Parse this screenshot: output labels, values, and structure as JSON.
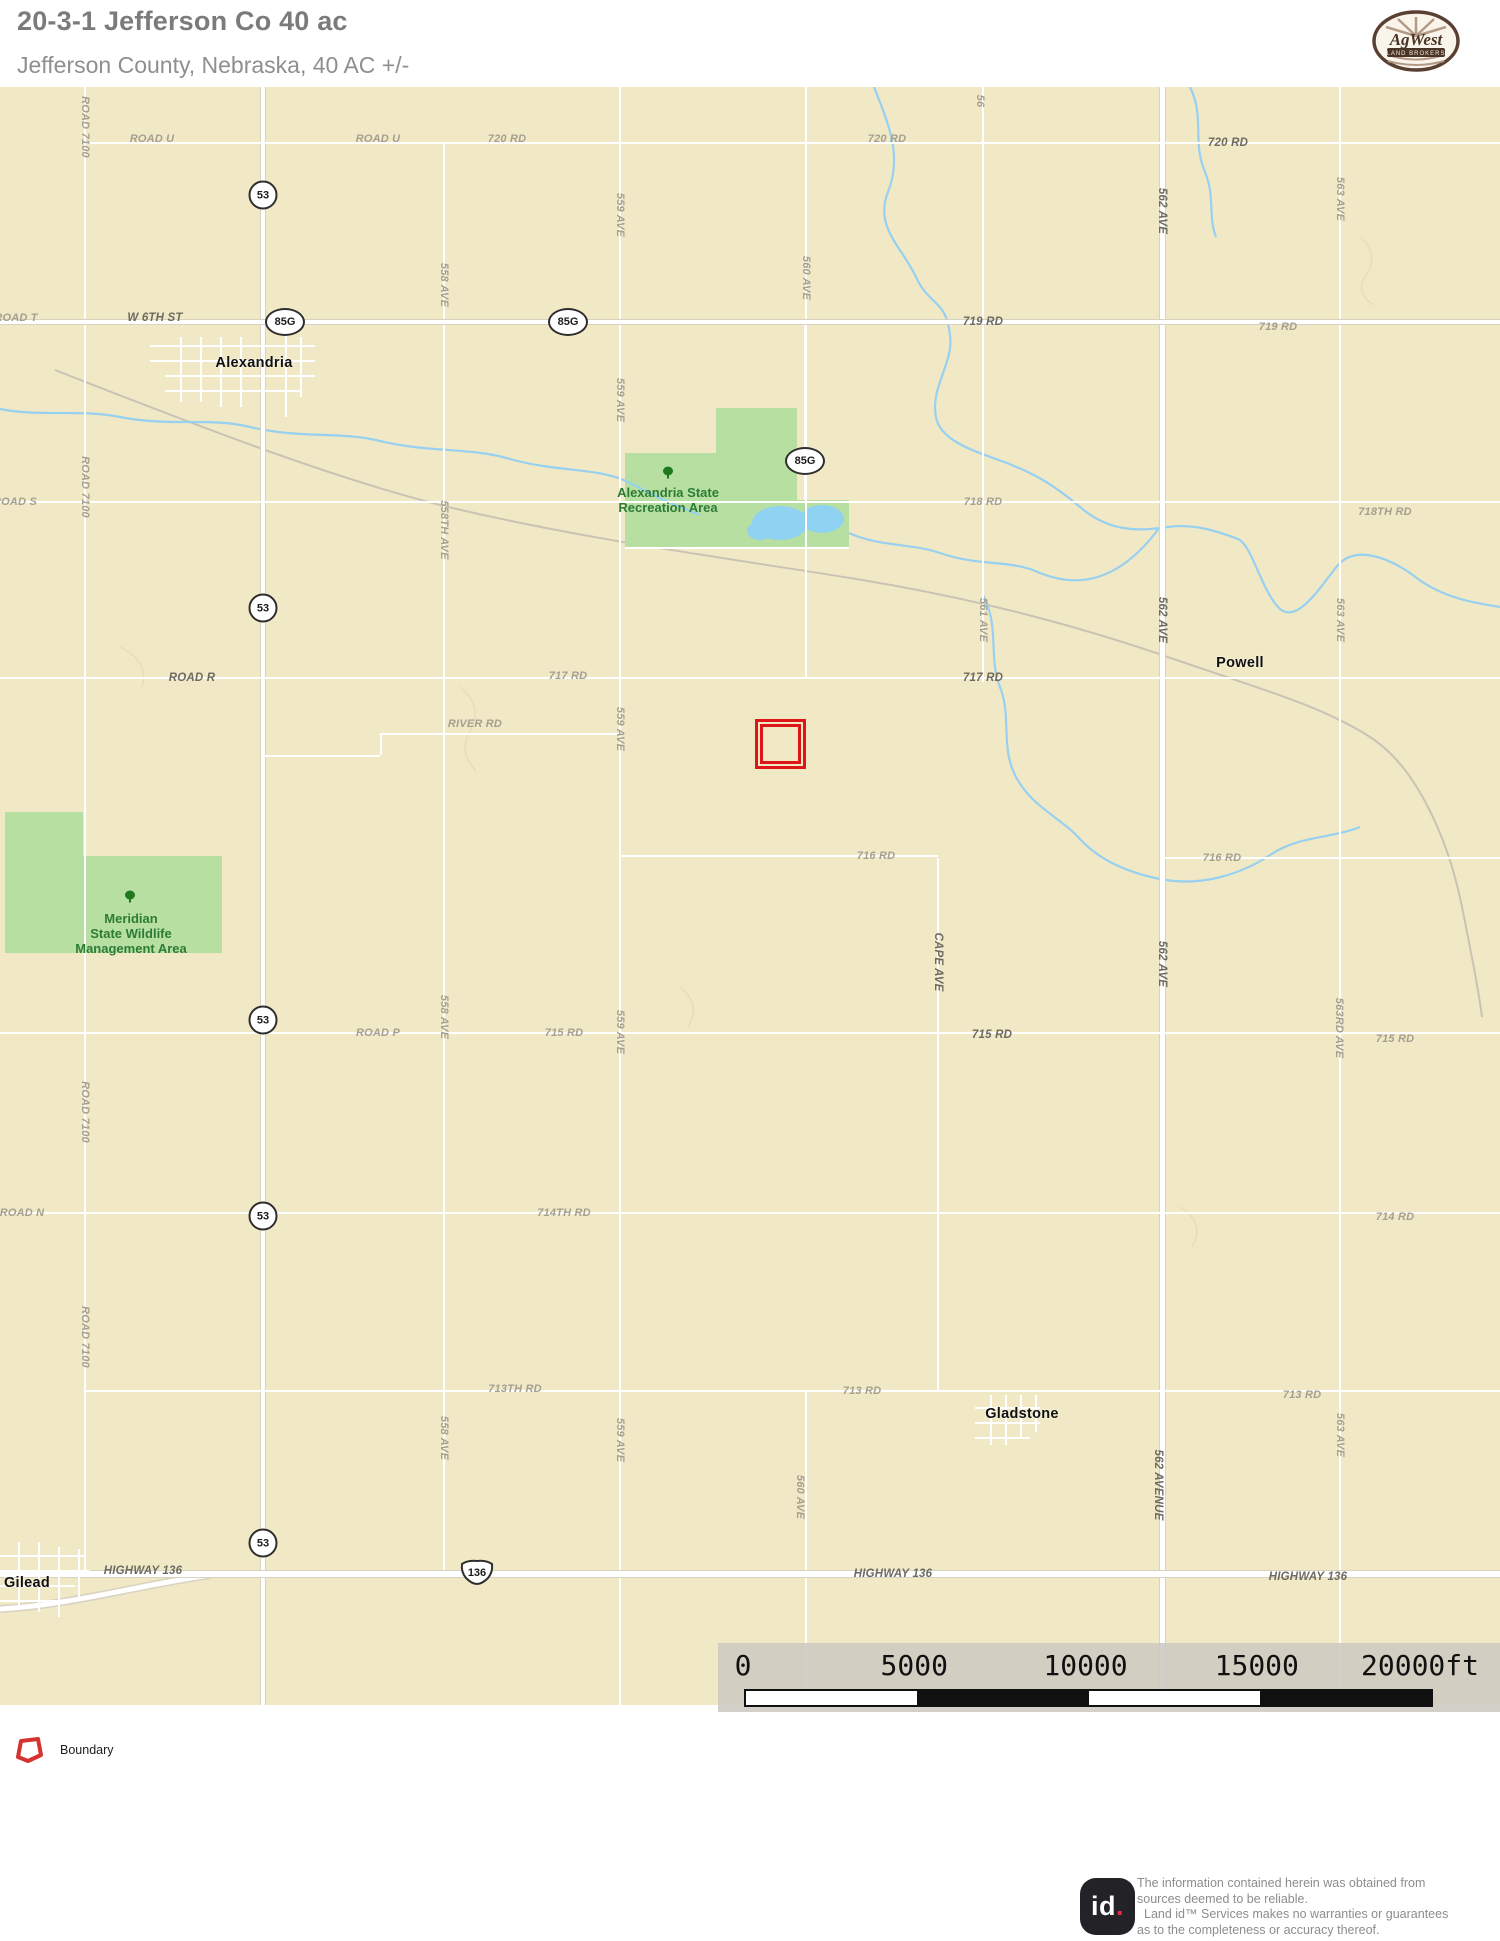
{
  "header": {
    "title": "20-3-1 Jefferson Co 40 ac",
    "subtitle": "Jefferson County, Nebraska, 40 AC +/-"
  },
  "brand": {
    "name": "AgWest",
    "tagline": "LAND BROKERS"
  },
  "colors": {
    "map_background": "#f1e9c5",
    "boundary_red": "#dd1717",
    "water_blue": "#8fd2f2",
    "park_green": "#b8dfa2",
    "park_text_green": "#2c7c35",
    "road_white": "#ffffff",
    "label_gray": "#a59f92"
  },
  "map": {
    "towns": [
      {
        "name": "Alexandria",
        "x": 254,
        "y": 276
      },
      {
        "name": "Powell",
        "x": 1240,
        "y": 576
      },
      {
        "name": "Gladstone",
        "x": 1022,
        "y": 1327
      },
      {
        "name": "Gilead",
        "x": 27,
        "y": 1496
      }
    ],
    "areas": [
      {
        "name": "Alexandria State Recreation Area",
        "lines": [
          "Alexandria State",
          "Recreation Area"
        ],
        "x": 668,
        "y": 398,
        "tree_x": 668,
        "tree_y": 388
      },
      {
        "name": "Meridian State Wildlife Management Area",
        "lines": [
          "Meridian",
          "State Wildlife",
          "Management Area"
        ],
        "x": 131,
        "y": 824,
        "tree_x": 130,
        "tree_y": 812
      }
    ],
    "shields": [
      {
        "type": "circle",
        "label": "53",
        "x": 263,
        "y": 108
      },
      {
        "type": "circle",
        "label": "53",
        "x": 263,
        "y": 521
      },
      {
        "type": "circle",
        "label": "53",
        "x": 263,
        "y": 933
      },
      {
        "type": "circle",
        "label": "53",
        "x": 263,
        "y": 1129
      },
      {
        "type": "circle",
        "label": "53",
        "x": 263,
        "y": 1456
      },
      {
        "type": "oval",
        "label": "85G",
        "x": 285,
        "y": 235
      },
      {
        "type": "oval",
        "label": "85G",
        "x": 568,
        "y": 235
      },
      {
        "type": "oval",
        "label": "85G",
        "x": 805,
        "y": 374
      },
      {
        "type": "us",
        "label": "136",
        "x": 477,
        "y": 1485
      }
    ],
    "road_labels": [
      {
        "text": "ROAD U",
        "x": 152,
        "y": 52
      },
      {
        "text": "ROAD U",
        "x": 378,
        "y": 52
      },
      {
        "text": "720 RD",
        "x": 507,
        "y": 52
      },
      {
        "text": "720 RD",
        "x": 887,
        "y": 52
      },
      {
        "text": "720 RD",
        "x": 1228,
        "y": 56,
        "bold": true
      },
      {
        "text": "ROAD T",
        "x": 16,
        "y": 231
      },
      {
        "text": "W 6TH ST",
        "x": 155,
        "y": 231,
        "bold": true
      },
      {
        "text": "719 RD",
        "x": 983,
        "y": 235,
        "bold": true
      },
      {
        "text": "719 RD",
        "x": 1278,
        "y": 240
      },
      {
        "text": "ROAD S",
        "x": 15,
        "y": 415
      },
      {
        "text": "718 RD",
        "x": 983,
        "y": 415
      },
      {
        "text": "718TH RD",
        "x": 1385,
        "y": 425
      },
      {
        "text": "ROAD R",
        "x": 192,
        "y": 591,
        "bold": true
      },
      {
        "text": "717 RD",
        "x": 568,
        "y": 589
      },
      {
        "text": "717 RD",
        "x": 983,
        "y": 591,
        "bold": true
      },
      {
        "text": "RIVER RD",
        "x": 475,
        "y": 637
      },
      {
        "text": "716 RD",
        "x": 876,
        "y": 769
      },
      {
        "text": "716 RD",
        "x": 1222,
        "y": 771
      },
      {
        "text": "ROAD P",
        "x": 378,
        "y": 946
      },
      {
        "text": "715 RD",
        "x": 564,
        "y": 946
      },
      {
        "text": "715 RD",
        "x": 992,
        "y": 948,
        "bold": true
      },
      {
        "text": "715 RD",
        "x": 1395,
        "y": 952
      },
      {
        "text": "ROAD N",
        "x": 22,
        "y": 1126
      },
      {
        "text": "714TH RD",
        "x": 564,
        "y": 1126
      },
      {
        "text": "714 RD",
        "x": 1395,
        "y": 1130
      },
      {
        "text": "713TH RD",
        "x": 515,
        "y": 1302
      },
      {
        "text": "713 RD",
        "x": 862,
        "y": 1304
      },
      {
        "text": "713 RD",
        "x": 1302,
        "y": 1308
      },
      {
        "text": "HIGHWAY 136",
        "x": 143,
        "y": 1484,
        "bold": true
      },
      {
        "text": "HIGHWAY 136",
        "x": 893,
        "y": 1487,
        "bold": true
      },
      {
        "text": "HIGHWAY 136",
        "x": 1308,
        "y": 1490,
        "bold": true
      }
    ],
    "vertical_labels": [
      {
        "text": "ROAD 7100",
        "x": 85,
        "y": 40
      },
      {
        "text": "ROAD 7100",
        "x": 85,
        "y": 400
      },
      {
        "text": "ROAD 7100",
        "x": 85,
        "y": 1025
      },
      {
        "text": "ROAD 7100",
        "x": 85,
        "y": 1250
      },
      {
        "text": "558 AVE",
        "x": 444,
        "y": 198
      },
      {
        "text": "558TH AVE",
        "x": 444,
        "y": 443
      },
      {
        "text": "558 AVE",
        "x": 444,
        "y": 930
      },
      {
        "text": "558 AVE",
        "x": 444,
        "y": 1351
      },
      {
        "text": "559 AVE",
        "x": 620,
        "y": 128
      },
      {
        "text": "559 AVE",
        "x": 620,
        "y": 313
      },
      {
        "text": "559 AVE",
        "x": 620,
        "y": 642
      },
      {
        "text": "559 AVE",
        "x": 620,
        "y": 945
      },
      {
        "text": "559 AVE",
        "x": 620,
        "y": 1353
      },
      {
        "text": "560 AVE",
        "x": 806,
        "y": 191
      },
      {
        "text": "560 AVE",
        "x": 800,
        "y": 1410
      },
      {
        "text": "56",
        "x": 980,
        "y": 14
      },
      {
        "text": "561 AVE",
        "x": 983,
        "y": 533
      },
      {
        "text": "CAPE AVE",
        "x": 938,
        "y": 875,
        "bold": true
      },
      {
        "text": "562 AVE",
        "x": 1162,
        "y": 124,
        "bold": true
      },
      {
        "text": "562 AVE",
        "x": 1162,
        "y": 533,
        "bold": true
      },
      {
        "text": "562 AVE",
        "x": 1162,
        "y": 877,
        "bold": true
      },
      {
        "text": "562 AVENUE",
        "x": 1158,
        "y": 1398,
        "bold": true
      },
      {
        "text": "563 AVE",
        "x": 1340,
        "y": 112
      },
      {
        "text": "563 AVE",
        "x": 1340,
        "y": 533
      },
      {
        "text": "563RD AVE",
        "x": 1339,
        "y": 941
      },
      {
        "text": "563 AVE",
        "x": 1340,
        "y": 1348
      }
    ]
  },
  "scalebar": {
    "labels": [
      "0",
      "5000",
      "10000",
      "15000",
      "20000ft"
    ]
  },
  "legend": {
    "items": [
      {
        "label": "Boundary"
      }
    ]
  },
  "footer": {
    "logo_id": "id",
    "logo_dot": ".",
    "lines": [
      "The information contained herein was obtained from",
      "sources deemed to be reliable.",
      "Land id™ Services makes no warranties or guarantees",
      "as to the completeness or accuracy thereof."
    ]
  }
}
